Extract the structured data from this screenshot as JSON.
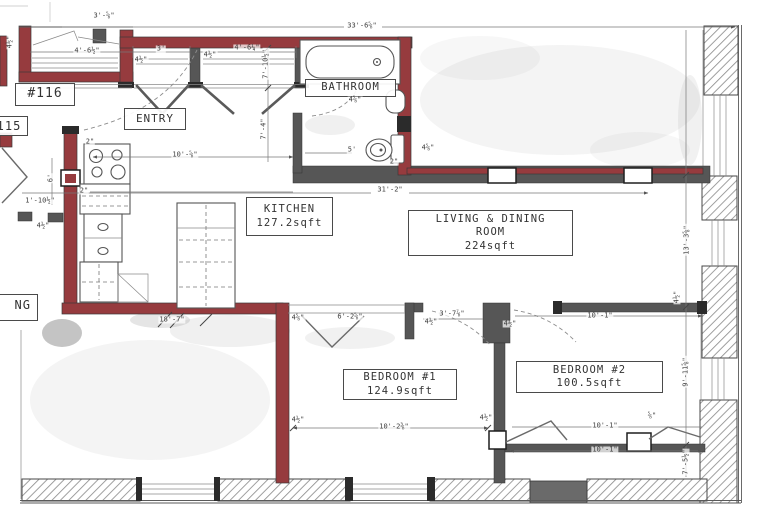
{
  "colors": {
    "wall_red": "#963b3e",
    "wall_dark": "#565656",
    "line": "#555555",
    "dim_text": "#3d3d3d"
  },
  "rooms": {
    "unit116": {
      "name": "#116"
    },
    "unit115": {
      "name": "115"
    },
    "entry": {
      "name": "ENTRY"
    },
    "bathroom": {
      "name": "BATHROOM"
    },
    "kitchen": {
      "name": "KITCHEN",
      "area": "127.2sqft"
    },
    "living": {
      "line1": "LIVING & DINING",
      "line2": "ROOM",
      "area": "224sqft"
    },
    "bedroom1": {
      "name": "BEDROOM #1",
      "area": "124.9sqft"
    },
    "bedroom2": {
      "name": "BEDROOM #2",
      "area": "100.5sqft"
    },
    "partial": {
      "name": "NG"
    }
  },
  "dimensions": [
    {
      "t": "33'-6⅝\"",
      "x": 362,
      "y": 26,
      "r": 0
    },
    {
      "t": "3'-⅝\"",
      "x": 104,
      "y": 16,
      "r": 0
    },
    {
      "t": "4½\"",
      "x": 10,
      "y": 42,
      "r": -90
    },
    {
      "t": "4'-6½\"",
      "x": 87,
      "y": 51,
      "r": 0
    },
    {
      "t": "4½\"",
      "x": 141,
      "y": 60,
      "r": 0
    },
    {
      "t": "3'",
      "x": 161,
      "y": 49,
      "r": 0
    },
    {
      "t": "4½\"",
      "x": 210,
      "y": 55,
      "r": 0
    },
    {
      "t": "4'-6¼\"",
      "x": 247,
      "y": 48,
      "r": 0
    },
    {
      "t": "7'-10½\"",
      "x": 266,
      "y": 64,
      "r": -90
    },
    {
      "t": "7'-4\"",
      "x": 264,
      "y": 129,
      "r": -90
    },
    {
      "t": "4⅝\"",
      "x": 355,
      "y": 100,
      "r": 0
    },
    {
      "t": "2\"",
      "x": 90,
      "y": 142,
      "r": 0
    },
    {
      "t": "10'-⅝\"",
      "x": 185,
      "y": 155,
      "r": 0
    },
    {
      "t": "2\"",
      "x": 84,
      "y": 191,
      "r": 0
    },
    {
      "t": "5'",
      "x": 352,
      "y": 150,
      "r": 0
    },
    {
      "t": "2\"",
      "x": 394,
      "y": 162,
      "r": 0
    },
    {
      "t": "6'",
      "x": 51,
      "y": 178,
      "r": -90
    },
    {
      "t": "1'-10½\"",
      "x": 40,
      "y": 201,
      "r": 0
    },
    {
      "t": "4½\"",
      "x": 43,
      "y": 226,
      "r": 0
    },
    {
      "t": "31'-2\"",
      "x": 390,
      "y": 190,
      "r": 0
    },
    {
      "t": "4⅝\"",
      "x": 428,
      "y": 148,
      "r": 0
    },
    {
      "t": "18'-7\"",
      "x": 172,
      "y": 320,
      "r": 0
    },
    {
      "t": "4⅝\"",
      "x": 298,
      "y": 318,
      "r": 0
    },
    {
      "t": "6'-2⅝\"",
      "x": 350,
      "y": 317,
      "r": 0
    },
    {
      "t": "3'-7⅞\"",
      "x": 452,
      "y": 314,
      "r": 0
    },
    {
      "t": "4½\"",
      "x": 431,
      "y": 322,
      "r": 0
    },
    {
      "t": "4½\"",
      "x": 510,
      "y": 324,
      "r": 0
    },
    {
      "t": "10'-1\"",
      "x": 600,
      "y": 316,
      "r": 0
    },
    {
      "t": "4½\"",
      "x": 677,
      "y": 297,
      "r": -90
    },
    {
      "t": "13'-3⅝\"",
      "x": 687,
      "y": 240,
      "r": -90
    },
    {
      "t": "9'-11⅝\"",
      "x": 686,
      "y": 372,
      "r": -90
    },
    {
      "t": "4½\"",
      "x": 298,
      "y": 420,
      "r": 0
    },
    {
      "t": "10'-2⅜\"",
      "x": 394,
      "y": 427,
      "r": 0
    },
    {
      "t": "4½\"",
      "x": 486,
      "y": 418,
      "r": 0
    },
    {
      "t": "10'-1\"",
      "x": 605,
      "y": 426,
      "r": 0
    },
    {
      "t": "⅝\"",
      "x": 652,
      "y": 416,
      "r": 0
    },
    {
      "t": "10'-1\"",
      "x": 605,
      "y": 450,
      "r": 0
    },
    {
      "t": "7'-5½\"",
      "x": 686,
      "y": 462,
      "r": -90
    }
  ]
}
